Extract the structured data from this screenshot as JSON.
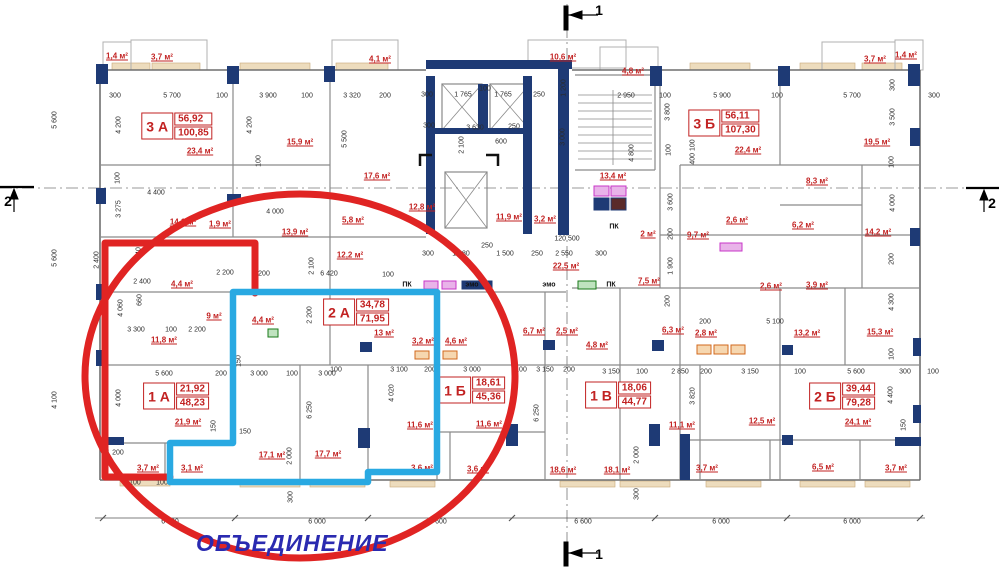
{
  "colors": {
    "wall_navy": "#1e3a75",
    "wall_gray": "#8a8a8a",
    "area_red": "#c22222",
    "dim_ink": "#2b2b2b",
    "annotation_red": "#e02423",
    "annotation_cyan": "#29a9e2",
    "merge_blue": "#2a2ab0",
    "window_beige": "#eddcbd",
    "vent_magenta": "#c837c8",
    "vent_orange": "#d2691e",
    "vent_green": "#1a7a1a"
  },
  "apartments": [
    {
      "unit": "3 А",
      "living": "56,92",
      "total": "100,85",
      "x": 177,
      "y": 126
    },
    {
      "unit": "3 Б",
      "living": "56,11",
      "total": "107,30",
      "x": 724,
      "y": 123
    },
    {
      "unit": "2 А",
      "living": "34,78",
      "total": "71,95",
      "x": 356,
      "y": 312
    },
    {
      "unit": "1 А",
      "living": "21,92",
      "total": "48,23",
      "x": 176,
      "y": 396
    },
    {
      "unit": "1 Б",
      "living": "18,61",
      "total": "45,36",
      "x": 472,
      "y": 390
    },
    {
      "unit": "1 В",
      "living": "18,06",
      "total": "44,77",
      "x": 618,
      "y": 395
    },
    {
      "unit": "2 Б",
      "living": "39,44",
      "total": "79,28",
      "x": 842,
      "y": 396
    }
  ],
  "room_areas": [
    {
      "t": "1,4 м²",
      "x": 117,
      "y": 56
    },
    {
      "t": "3,7 м²",
      "x": 162,
      "y": 57
    },
    {
      "t": "4,1 м²",
      "x": 380,
      "y": 59
    },
    {
      "t": "10,6 м²",
      "x": 563,
      "y": 57
    },
    {
      "t": "4,8 м²",
      "x": 633,
      "y": 71
    },
    {
      "t": "3,7 м²",
      "x": 875,
      "y": 59
    },
    {
      "t": "1,4 м²",
      "x": 906,
      "y": 55
    },
    {
      "t": "23,4 м²",
      "x": 200,
      "y": 151
    },
    {
      "t": "15,9 м²",
      "x": 300,
      "y": 142
    },
    {
      "t": "22,4 м²",
      "x": 748,
      "y": 150
    },
    {
      "t": "19,5 м²",
      "x": 877,
      "y": 142
    },
    {
      "t": "17,6 м²",
      "x": 377,
      "y": 176
    },
    {
      "t": "12,8 м²",
      "x": 422,
      "y": 207
    },
    {
      "t": "11,9 м²",
      "x": 509,
      "y": 217
    },
    {
      "t": "3,2 м²",
      "x": 545,
      "y": 219
    },
    {
      "t": "13,4 м²",
      "x": 613,
      "y": 176
    },
    {
      "t": "8,3 м²",
      "x": 817,
      "y": 181
    },
    {
      "t": "14,1 м²",
      "x": 183,
      "y": 222
    },
    {
      "t": "1,9 м²",
      "x": 220,
      "y": 224
    },
    {
      "t": "13,9 м²",
      "x": 295,
      "y": 232
    },
    {
      "t": "5,8 м²",
      "x": 353,
      "y": 220
    },
    {
      "t": "12,2 м²",
      "x": 350,
      "y": 255
    },
    {
      "t": "22,5 м²",
      "x": 566,
      "y": 266
    },
    {
      "t": "2 м²",
      "x": 648,
      "y": 234
    },
    {
      "t": "9,7 м²",
      "x": 698,
      "y": 235
    },
    {
      "t": "2,6 м²",
      "x": 737,
      "y": 220
    },
    {
      "t": "6,2 м²",
      "x": 803,
      "y": 225
    },
    {
      "t": "2,6 м²",
      "x": 771,
      "y": 286
    },
    {
      "t": "7,5 м²",
      "x": 649,
      "y": 281
    },
    {
      "t": "14,2 м²",
      "x": 878,
      "y": 232
    },
    {
      "t": "3,9 м²",
      "x": 817,
      "y": 285
    },
    {
      "t": "4,4 м²",
      "x": 182,
      "y": 284
    },
    {
      "t": "9 м²",
      "x": 214,
      "y": 316
    },
    {
      "t": "4,4 м²",
      "x": 263,
      "y": 320
    },
    {
      "t": "11,8 м²",
      "x": 164,
      "y": 340
    },
    {
      "t": "13 м²",
      "x": 384,
      "y": 333
    },
    {
      "t": "3,2 м²",
      "x": 423,
      "y": 341
    },
    {
      "t": "4,6 м²",
      "x": 456,
      "y": 341
    },
    {
      "t": "6,7 м²",
      "x": 534,
      "y": 331
    },
    {
      "t": "2,5 м²",
      "x": 567,
      "y": 331
    },
    {
      "t": "6,3 м²",
      "x": 673,
      "y": 330
    },
    {
      "t": "2,8 м²",
      "x": 706,
      "y": 333
    },
    {
      "t": "4,8 м²",
      "x": 597,
      "y": 345
    },
    {
      "t": "13,2 м²",
      "x": 807,
      "y": 333
    },
    {
      "t": "15,3 м²",
      "x": 880,
      "y": 332
    },
    {
      "t": "21,9 м²",
      "x": 188,
      "y": 422
    },
    {
      "t": "3,7 м²",
      "x": 148,
      "y": 468
    },
    {
      "t": "3,1 м²",
      "x": 192,
      "y": 468
    },
    {
      "t": "17,1 м²",
      "x": 272,
      "y": 455
    },
    {
      "t": "17,7 м²",
      "x": 328,
      "y": 454
    },
    {
      "t": "11,6 м²",
      "x": 420,
      "y": 425
    },
    {
      "t": "11,6 м²",
      "x": 489,
      "y": 424
    },
    {
      "t": "3,6 м²",
      "x": 422,
      "y": 468
    },
    {
      "t": "3,6 м²",
      "x": 478,
      "y": 469
    },
    {
      "t": "18,6 м²",
      "x": 563,
      "y": 470
    },
    {
      "t": "18,1 м²",
      "x": 617,
      "y": 470
    },
    {
      "t": "11,1 м²",
      "x": 682,
      "y": 425
    },
    {
      "t": "12,5 м²",
      "x": 762,
      "y": 421
    },
    {
      "t": "3,7 м²",
      "x": 707,
      "y": 468
    },
    {
      "t": "24,1 м²",
      "x": 858,
      "y": 422
    },
    {
      "t": "6,5 м²",
      "x": 823,
      "y": 467
    },
    {
      "t": "3,7 м²",
      "x": 896,
      "y": 468
    }
  ],
  "dimensions": [
    {
      "t": "300",
      "x": 115,
      "y": 96
    },
    {
      "t": "5 700",
      "x": 172,
      "y": 96
    },
    {
      "t": "100",
      "x": 222,
      "y": 96
    },
    {
      "t": "3 900",
      "x": 268,
      "y": 96
    },
    {
      "t": "100",
      "x": 307,
      "y": 96
    },
    {
      "t": "3 320",
      "x": 352,
      "y": 96
    },
    {
      "t": "200",
      "x": 385,
      "y": 96
    },
    {
      "t": "300",
      "x": 427,
      "y": 95
    },
    {
      "t": "1 765",
      "x": 463,
      "y": 95
    },
    {
      "t": "100",
      "x": 485,
      "y": 89
    },
    {
      "t": "1 765",
      "x": 503,
      "y": 95
    },
    {
      "t": "250",
      "x": 539,
      "y": 95
    },
    {
      "t": "2 950",
      "x": 626,
      "y": 96
    },
    {
      "t": "100",
      "x": 665,
      "y": 96
    },
    {
      "t": "5 900",
      "x": 722,
      "y": 96
    },
    {
      "t": "100",
      "x": 777,
      "y": 96
    },
    {
      "t": "5 700",
      "x": 852,
      "y": 96
    },
    {
      "t": "300",
      "x": 934,
      "y": 96
    },
    {
      "t": "1 200",
      "x": 564,
      "y": 88,
      "v": 1
    },
    {
      "t": "300",
      "x": 893,
      "y": 85,
      "v": 1
    },
    {
      "t": "3 500",
      "x": 893,
      "y": 117,
      "v": 1
    },
    {
      "t": "100",
      "x": 892,
      "y": 162,
      "v": 1
    },
    {
      "t": "4 200",
      "x": 119,
      "y": 125,
      "v": 1
    },
    {
      "t": "4 200",
      "x": 250,
      "y": 125,
      "v": 1
    },
    {
      "t": "100",
      "x": 259,
      "y": 161,
      "v": 1
    },
    {
      "t": "5 500",
      "x": 345,
      "y": 139,
      "v": 1
    },
    {
      "t": "5 600",
      "x": 55,
      "y": 120,
      "v": 1
    },
    {
      "t": "5 600",
      "x": 55,
      "y": 258,
      "v": 1
    },
    {
      "t": "4 100",
      "x": 55,
      "y": 400,
      "v": 1
    },
    {
      "t": "300",
      "x": 429,
      "y": 126
    },
    {
      "t": "3 630",
      "x": 475,
      "y": 128
    },
    {
      "t": "250",
      "x": 514,
      "y": 127
    },
    {
      "t": "600",
      "x": 501,
      "y": 142
    },
    {
      "t": "2 100",
      "x": 462,
      "y": 145,
      "v": 1
    },
    {
      "t": "3 000",
      "x": 563,
      "y": 137,
      "v": 1
    },
    {
      "t": "3 800",
      "x": 668,
      "y": 112,
      "v": 1
    },
    {
      "t": "4 800",
      "x": 632,
      "y": 153,
      "v": 1
    },
    {
      "t": "100",
      "x": 669,
      "y": 150,
      "v": 1
    },
    {
      "t": "400 100",
      "x": 693,
      "y": 152,
      "v": 1
    },
    {
      "t": "100",
      "x": 118,
      "y": 178,
      "v": 1
    },
    {
      "t": "3 275",
      "x": 119,
      "y": 209,
      "v": 1
    },
    {
      "t": "4 400",
      "x": 156,
      "y": 193
    },
    {
      "t": "4 000",
      "x": 275,
      "y": 212
    },
    {
      "t": "2 400",
      "x": 97,
      "y": 260,
      "v": 1
    },
    {
      "t": "640",
      "x": 139,
      "y": 253,
      "v": 1
    },
    {
      "t": "660",
      "x": 140,
      "y": 300,
      "v": 1
    },
    {
      "t": "2 400",
      "x": 142,
      "y": 282
    },
    {
      "t": "2 200",
      "x": 225,
      "y": 273
    },
    {
      "t": "200",
      "x": 264,
      "y": 274
    },
    {
      "t": "6 420",
      "x": 329,
      "y": 274
    },
    {
      "t": "100",
      "x": 388,
      "y": 275
    },
    {
      "t": "2 100",
      "x": 312,
      "y": 266,
      "v": 1
    },
    {
      "t": "300",
      "x": 428,
      "y": 254
    },
    {
      "t": "1 880",
      "x": 461,
      "y": 254
    },
    {
      "t": "250",
      "x": 487,
      "y": 246
    },
    {
      "t": "1 500",
      "x": 505,
      "y": 254
    },
    {
      "t": "250",
      "x": 537,
      "y": 254
    },
    {
      "t": "2 550",
      "x": 564,
      "y": 254
    },
    {
      "t": "120 500",
      "x": 567,
      "y": 239
    },
    {
      "t": "300",
      "x": 601,
      "y": 254
    },
    {
      "t": "3 600",
      "x": 671,
      "y": 202,
      "v": 1
    },
    {
      "t": "200",
      "x": 671,
      "y": 234,
      "v": 1
    },
    {
      "t": "1 900",
      "x": 671,
      "y": 266,
      "v": 1
    },
    {
      "t": "4 000",
      "x": 893,
      "y": 203,
      "v": 1
    },
    {
      "t": "200",
      "x": 892,
      "y": 259,
      "v": 1
    },
    {
      "t": "4 300",
      "x": 892,
      "y": 302,
      "v": 1
    },
    {
      "t": "4 060",
      "x": 121,
      "y": 308,
      "v": 1
    },
    {
      "t": "2 200",
      "x": 310,
      "y": 315,
      "v": 1
    },
    {
      "t": "3 300",
      "x": 136,
      "y": 330
    },
    {
      "t": "100",
      "x": 171,
      "y": 330
    },
    {
      "t": "2 200",
      "x": 197,
      "y": 330
    },
    {
      "t": "150",
      "x": 239,
      "y": 361,
      "v": 1
    },
    {
      "t": "5 600",
      "x": 164,
      "y": 374
    },
    {
      "t": "200",
      "x": 221,
      "y": 374
    },
    {
      "t": "3 000",
      "x": 259,
      "y": 374
    },
    {
      "t": "100",
      "x": 292,
      "y": 374
    },
    {
      "t": "3 000",
      "x": 327,
      "y": 374
    },
    {
      "t": "4 000",
      "x": 119,
      "y": 398,
      "v": 1
    },
    {
      "t": "6 250",
      "x": 310,
      "y": 410,
      "v": 1
    },
    {
      "t": "150",
      "x": 245,
      "y": 432
    },
    {
      "t": "2 000",
      "x": 290,
      "y": 456,
      "v": 1
    },
    {
      "t": "300",
      "x": 291,
      "y": 497,
      "v": 1
    },
    {
      "t": "1 200",
      "x": 115,
      "y": 453
    },
    {
      "t": "3 100",
      "x": 132,
      "y": 483
    },
    {
      "t": "100",
      "x": 162,
      "y": 483
    },
    {
      "t": "150",
      "x": 214,
      "y": 426,
      "v": 1
    },
    {
      "t": "100",
      "x": 336,
      "y": 370
    },
    {
      "t": "3 100",
      "x": 399,
      "y": 370
    },
    {
      "t": "200",
      "x": 430,
      "y": 370
    },
    {
      "t": "3 000",
      "x": 472,
      "y": 370
    },
    {
      "t": "100",
      "x": 521,
      "y": 370
    },
    {
      "t": "3 150",
      "x": 545,
      "y": 370
    },
    {
      "t": "200",
      "x": 569,
      "y": 370
    },
    {
      "t": "4 020",
      "x": 392,
      "y": 393,
      "v": 1
    },
    {
      "t": "6 250",
      "x": 537,
      "y": 413,
      "v": 1
    },
    {
      "t": "3 150",
      "x": 611,
      "y": 372
    },
    {
      "t": "100",
      "x": 642,
      "y": 372
    },
    {
      "t": "2 850",
      "x": 680,
      "y": 372
    },
    {
      "t": "200",
      "x": 706,
      "y": 372
    },
    {
      "t": "3 150",
      "x": 750,
      "y": 372
    },
    {
      "t": "3 820",
      "x": 693,
      "y": 396,
      "v": 1
    },
    {
      "t": "200",
      "x": 668,
      "y": 301,
      "v": 1
    },
    {
      "t": "200",
      "x": 705,
      "y": 322
    },
    {
      "t": "5 100",
      "x": 775,
      "y": 322
    },
    {
      "t": "100",
      "x": 800,
      "y": 372
    },
    {
      "t": "5 600",
      "x": 856,
      "y": 372
    },
    {
      "t": "300",
      "x": 905,
      "y": 372
    },
    {
      "t": "100",
      "x": 933,
      "y": 372
    },
    {
      "t": "100",
      "x": 892,
      "y": 354,
      "v": 1
    },
    {
      "t": "4 400",
      "x": 891,
      "y": 395,
      "v": 1
    },
    {
      "t": "150",
      "x": 904,
      "y": 425,
      "v": 1
    },
    {
      "t": "2 000",
      "x": 637,
      "y": 455,
      "v": 1
    },
    {
      "t": "300",
      "x": 637,
      "y": 494,
      "v": 1
    },
    {
      "t": "6 000",
      "x": 170,
      "y": 522
    },
    {
      "t": "6 000",
      "x": 317,
      "y": 522
    },
    {
      "t": "6 600",
      "x": 438,
      "y": 522
    },
    {
      "t": "6 600",
      "x": 583,
      "y": 522
    },
    {
      "t": "6 000",
      "x": 721,
      "y": 522
    },
    {
      "t": "6 000",
      "x": 852,
      "y": 522
    }
  ],
  "service_labels": [
    {
      "t": "ПК",
      "x": 407,
      "y": 285
    },
    {
      "t": "эмо",
      "x": 472,
      "y": 285
    },
    {
      "t": "эмо",
      "x": 549,
      "y": 285
    },
    {
      "t": "ПК",
      "x": 614,
      "y": 227
    },
    {
      "t": "ПК",
      "x": 611,
      "y": 285
    }
  ],
  "section_marks": [
    {
      "t": "1",
      "x": 599,
      "y": 10
    },
    {
      "t": "1",
      "x": 599,
      "y": 554
    },
    {
      "t": "2",
      "x": 8,
      "y": 201
    },
    {
      "t": "2",
      "x": 992,
      "y": 203
    }
  ],
  "annotations": {
    "merge_label": "ОБЪЕДИНЕНИЕ",
    "ellipse": {
      "cx": 300,
      "cy": 376,
      "rx": 215,
      "ry": 182
    },
    "red_outline": "170,477 105,477 105,243 255,243 255,293",
    "cyan_outline": "233,292 437,292 437,472 368,472 368,482 170,482 170,443 233,443"
  }
}
